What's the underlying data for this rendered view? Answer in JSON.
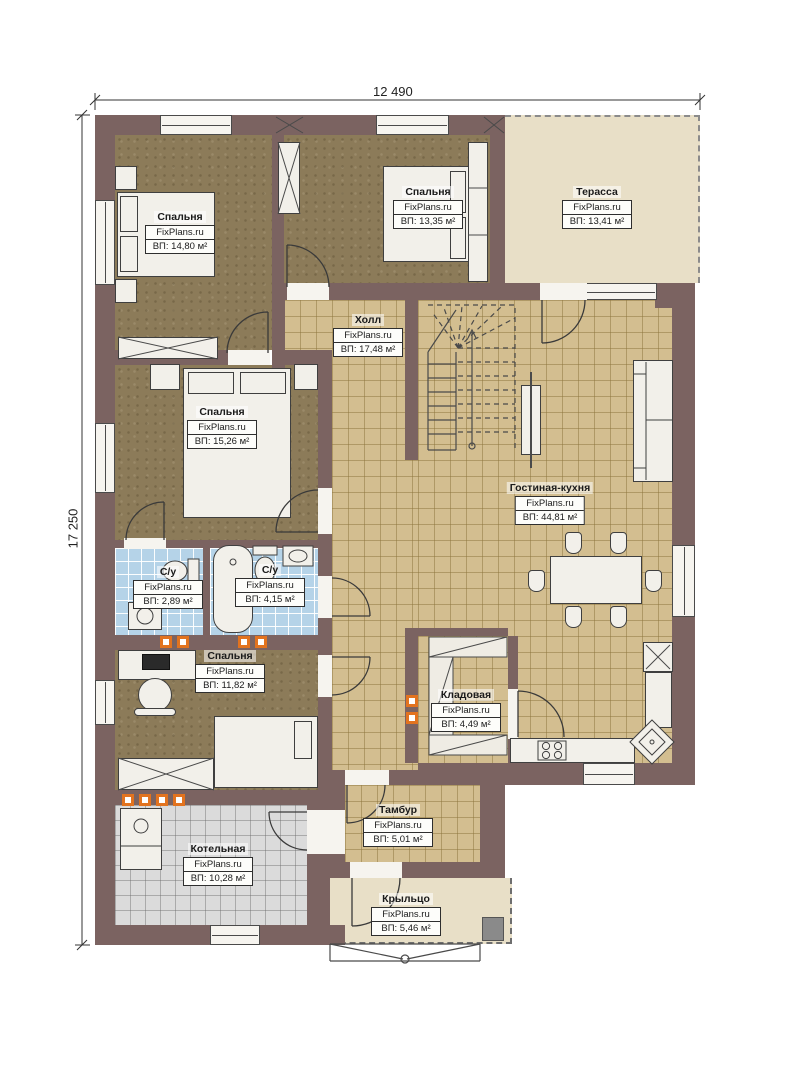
{
  "meta": {
    "watermark": "FixPlans.ru"
  },
  "dimensions": {
    "width_label": "12 490",
    "height_label": "17 250"
  },
  "colors": {
    "wall": "#7b6361",
    "tile_floor": "#d3be90",
    "bedroom_floor": "#8c7b59",
    "bath_tile": "#b5d3e8",
    "boiler_tile": "#dbdbdb",
    "terrace_floor": "#e8dfc7",
    "vent_accent": "#e2731f"
  },
  "rooms": {
    "bedroom1": {
      "name": "Спальня",
      "area": "ВП: 14,80 м²"
    },
    "bedroom2": {
      "name": "Спальня",
      "area": "ВП: 13,35 м²"
    },
    "terrace": {
      "name": "Терасса",
      "area": "ВП: 13,41 м²"
    },
    "hall": {
      "name": "Холл",
      "area": "ВП: 17,48 м²"
    },
    "bedroom3": {
      "name": "Спальня",
      "area": "ВП: 15,26 м²"
    },
    "living": {
      "name": "Гостиная-кухня",
      "area": "ВП: 44,81 м²"
    },
    "bath1": {
      "name": "С/у",
      "area": "ВП: 2,89 м²"
    },
    "bath2": {
      "name": "С/у",
      "area": "ВП: 4,15 м²"
    },
    "bedroom4": {
      "name": "Спальня",
      "area": "ВП: 11,82 м²"
    },
    "storage": {
      "name": "Кладовая",
      "area": "ВП: 4,49 м²"
    },
    "boiler": {
      "name": "Котельная",
      "area": "ВП: 10,28 м²"
    },
    "vestibule": {
      "name": "Тамбур",
      "area": "ВП: 5,01 м²"
    },
    "porch": {
      "name": "Крыльцо",
      "area": "ВП: 5,46 м²"
    }
  }
}
